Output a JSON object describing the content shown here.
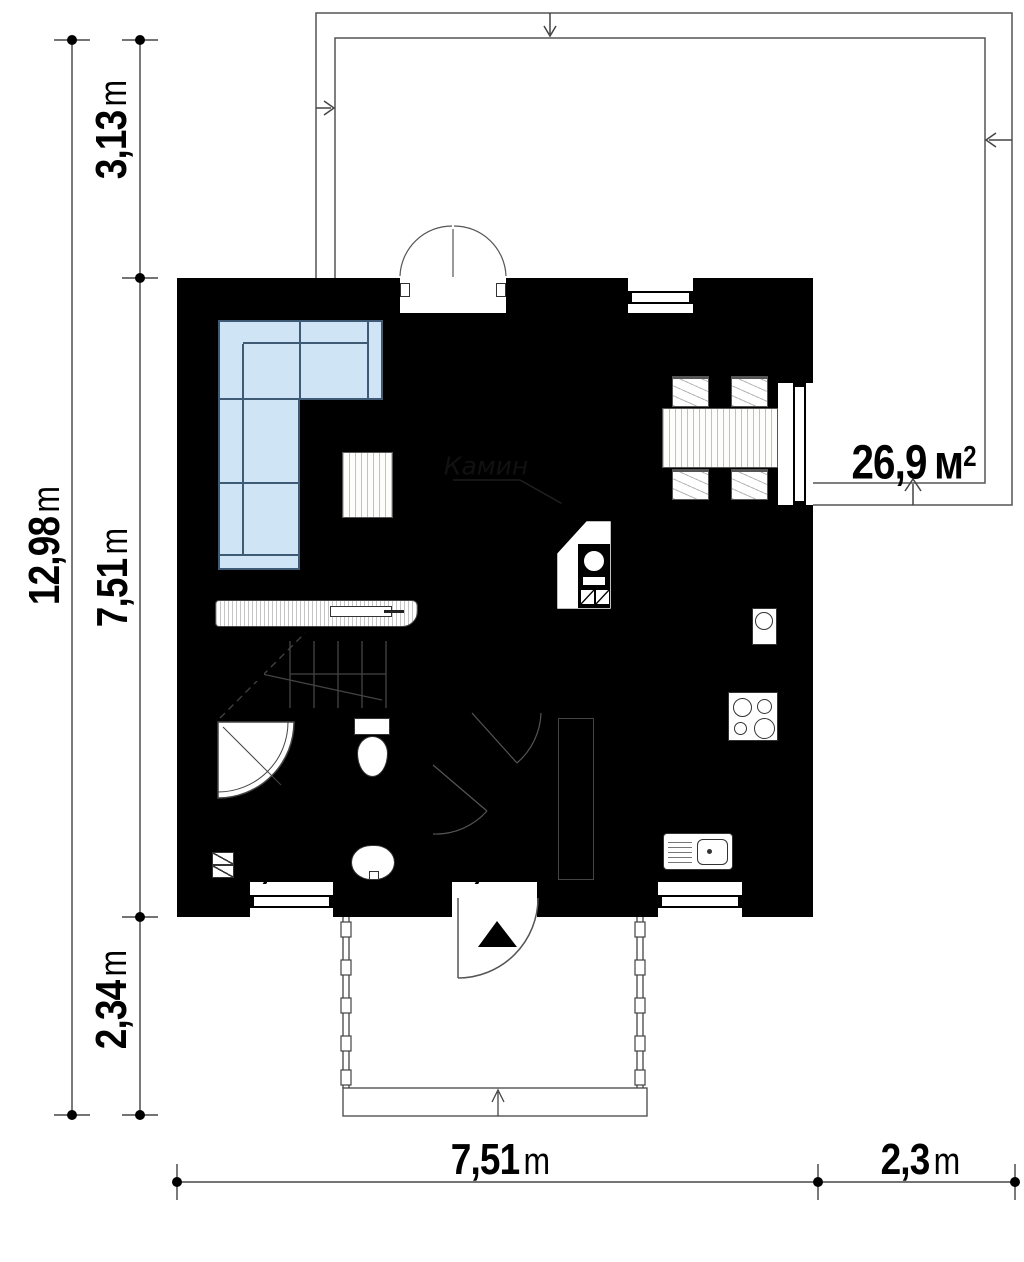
{
  "rooms": [
    {
      "name": "living-dining",
      "area_value": "24,0",
      "area_unit": "м",
      "area_sup": "2"
    },
    {
      "name": "terrace",
      "area_value": "26,9",
      "area_unit": "м",
      "area_sup": "2"
    },
    {
      "name": "corridor",
      "area_value": "4,1",
      "area_unit": "м",
      "area_sup": "2"
    },
    {
      "name": "kitchen",
      "area_value": "6,6",
      "area_unit": "м",
      "area_sup": "2"
    },
    {
      "name": "bathroom",
      "area_value": "4,7",
      "area_unit": "м",
      "area_sup": "2"
    },
    {
      "name": "hall",
      "area_value": "3,4",
      "area_unit": "м",
      "area_sup": "2"
    }
  ],
  "annotations": {
    "fireplace": "Камин"
  },
  "dimensions": [
    {
      "id": "left-top",
      "value": "3,13",
      "unit": "m"
    },
    {
      "id": "left-outer",
      "value": "12,98",
      "unit": "m"
    },
    {
      "id": "left-middle",
      "value": "7,51",
      "unit": "m"
    },
    {
      "id": "left-bottom",
      "value": "2,34",
      "unit": "m"
    },
    {
      "id": "bottom-house",
      "value": "7,51",
      "unit": "m"
    },
    {
      "id": "bottom-terrace",
      "value": "2,3",
      "unit": "m"
    }
  ],
  "colors": {
    "wall": "#000000",
    "floor": "#ebf1fa",
    "wet_floor": "#cbddf1",
    "sofa_fill": "#cfe4f5",
    "line": "#444444"
  }
}
